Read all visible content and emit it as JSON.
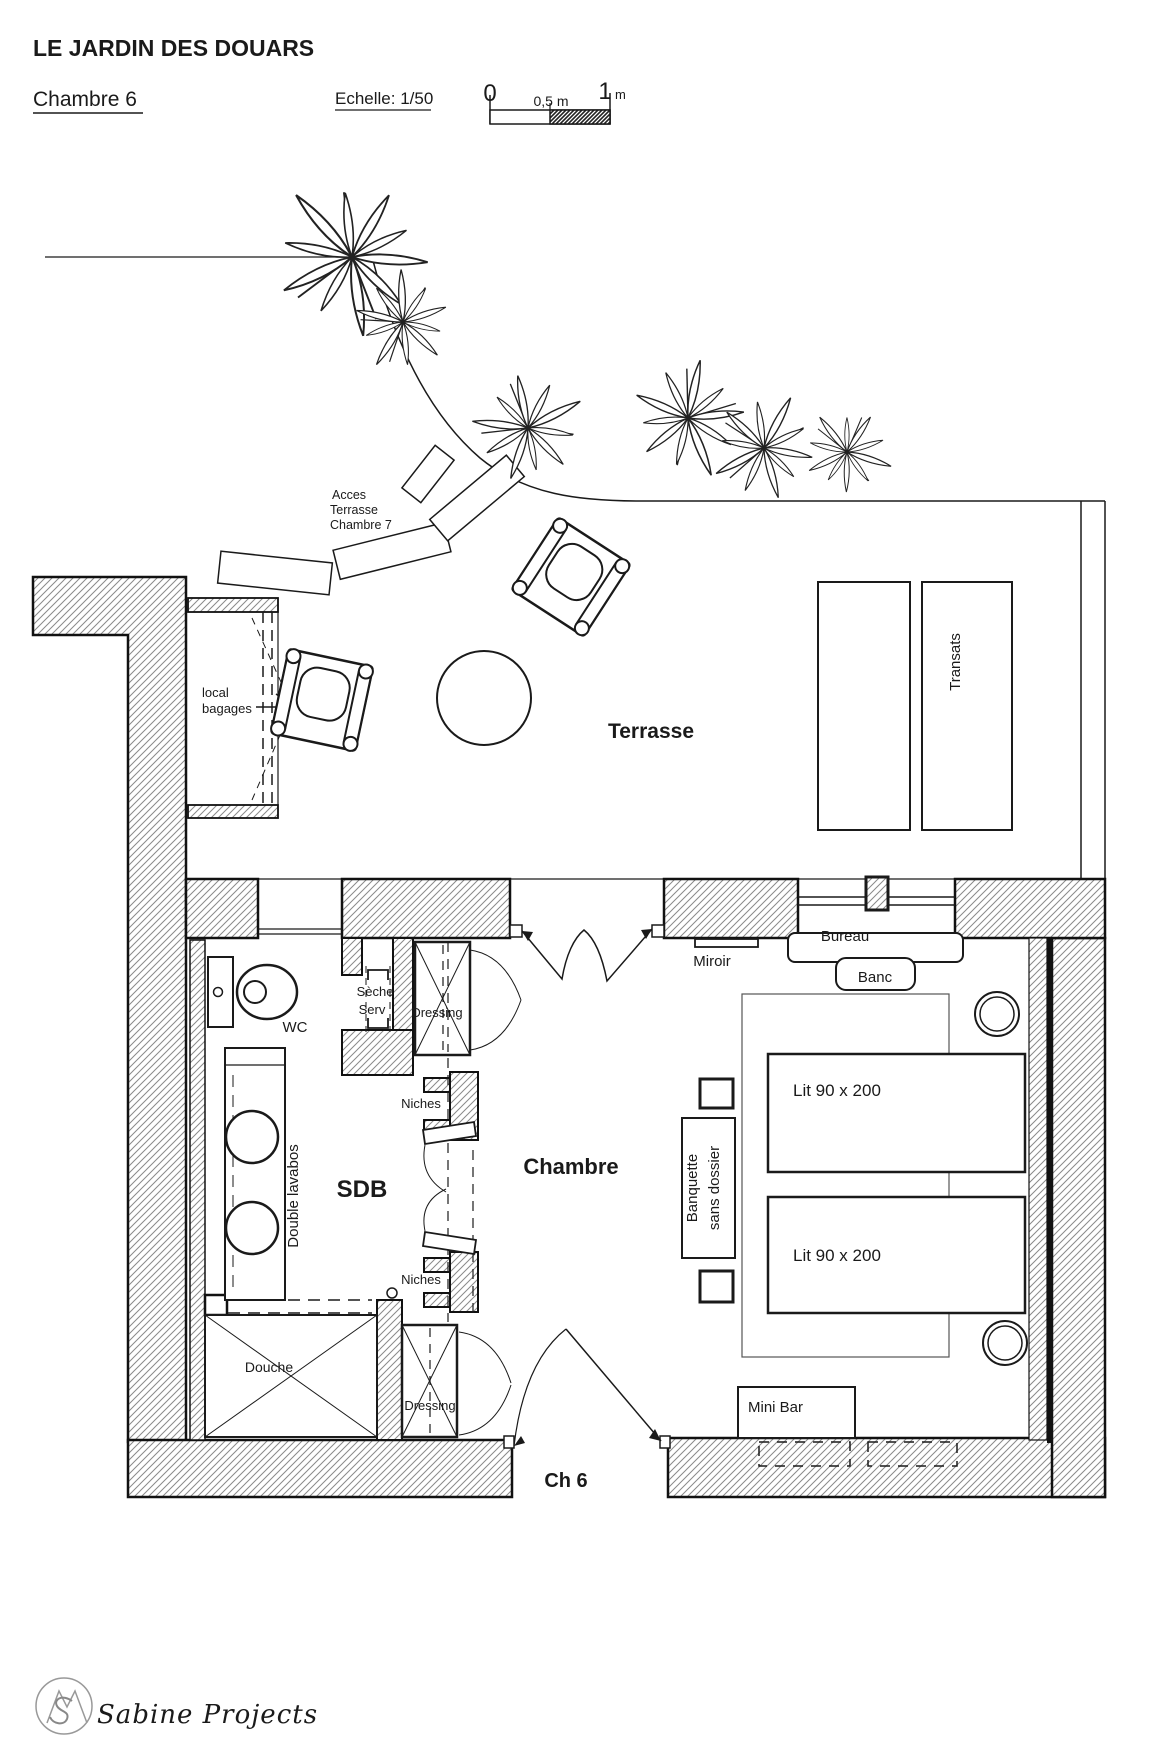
{
  "header": {
    "title": "LE JARDIN DES DOUARS",
    "room_title": "Chambre 6",
    "scale_label": "Echelle: 1/50",
    "scale_zero": "0",
    "scale_half": "0,5 m",
    "scale_one": "1",
    "scale_unit": "m"
  },
  "terrace": {
    "label": "Terrasse",
    "access_line1": "Acces",
    "access_line2": "Terrasse",
    "access_line3": "Chambre 7",
    "transats_label": "Transats",
    "luggage_line1": "local",
    "luggage_line2": "bagages"
  },
  "bathroom": {
    "label": "SDB",
    "wc_label": "WC",
    "towel_line1": "Sèche",
    "towel_line2": "Serv",
    "dressing_top_label": "Dressing",
    "dressing_bottom_label": "Dressing",
    "niches_top_label": "Niches",
    "niches_bottom_label": "Niches",
    "vanity_label": "Double lavabos",
    "shower_label": "Douche"
  },
  "bedroom": {
    "label": "Chambre",
    "mirror_label": "Miroir",
    "desk_label": "Bureau",
    "bench_label": "Banc",
    "bed1_label": "Lit 90 x 200",
    "bed2_label": "Lit 90 x 200",
    "banquette_line1": "Banquette",
    "banquette_line2": "sans dossier",
    "minibar_label": "Mini Bar",
    "entrance_label": "Ch 6"
  },
  "footer": {
    "logo_text": "Sabine Projects"
  },
  "colors": {
    "ink": "#1a1a1a",
    "logo_red": "#9c3f3c"
  }
}
